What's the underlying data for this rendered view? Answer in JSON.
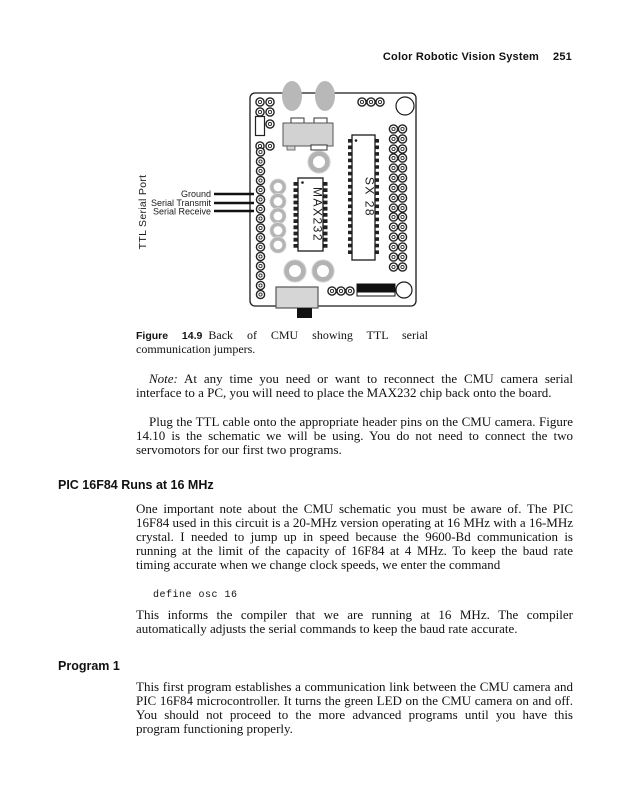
{
  "header": {
    "running_title": "Color Robotic Vision System",
    "page_number": "251"
  },
  "figure": {
    "board_labels": {
      "max232": "MAX232",
      "sx28": "SX 28"
    },
    "callouts": {
      "ttl_serial_port": "TTL Serial Port",
      "ground": "Ground",
      "serial_transmit": "Serial Transmit",
      "serial_receive": "Serial Receive"
    },
    "caption": {
      "number": "Figure 14.9",
      "text": "Back of CMU showing TTL serial communication jumpers."
    }
  },
  "body": {
    "note_paragraph": {
      "label": "Note:",
      "text": " At any time you need or want to reconnect the CMU camera serial interface to a PC, you will need to place the MAX232 chip back onto the board."
    },
    "plug_paragraph": "Plug the TTL cable onto the appropriate header pins on the CMU camera. Figure 14.10 is the schematic we will be using. You do not need to connect the two servomotors for our first two programs.",
    "section1": {
      "heading": "PIC 16F84 Runs at 16 MHz",
      "paragraph1": "One important note about the CMU schematic you must be aware of. The PIC 16F84 used in this circuit is a 20-MHz version operating at 16 MHz with a 16-MHz crystal. I needed to jump up in speed because the 9600-Bd communication is running at the limit of the capacity of 16F84 at 4 MHz. To keep the baud rate timing accurate when we change clock speeds, we enter the command",
      "code": "define osc 16",
      "paragraph2": "This informs the compiler that we are running at 16 MHz. The compiler automatically adjusts the serial commands to keep the baud rate accurate."
    },
    "section2": {
      "heading": "Program 1",
      "paragraph": "This first program establishes a communication link between the CMU camera and PIC 16F84 microcontroller. It turns the green LED on the CMU camera on and off. You should not proceed to the more advanced programs until you have this program functioning properly."
    }
  }
}
